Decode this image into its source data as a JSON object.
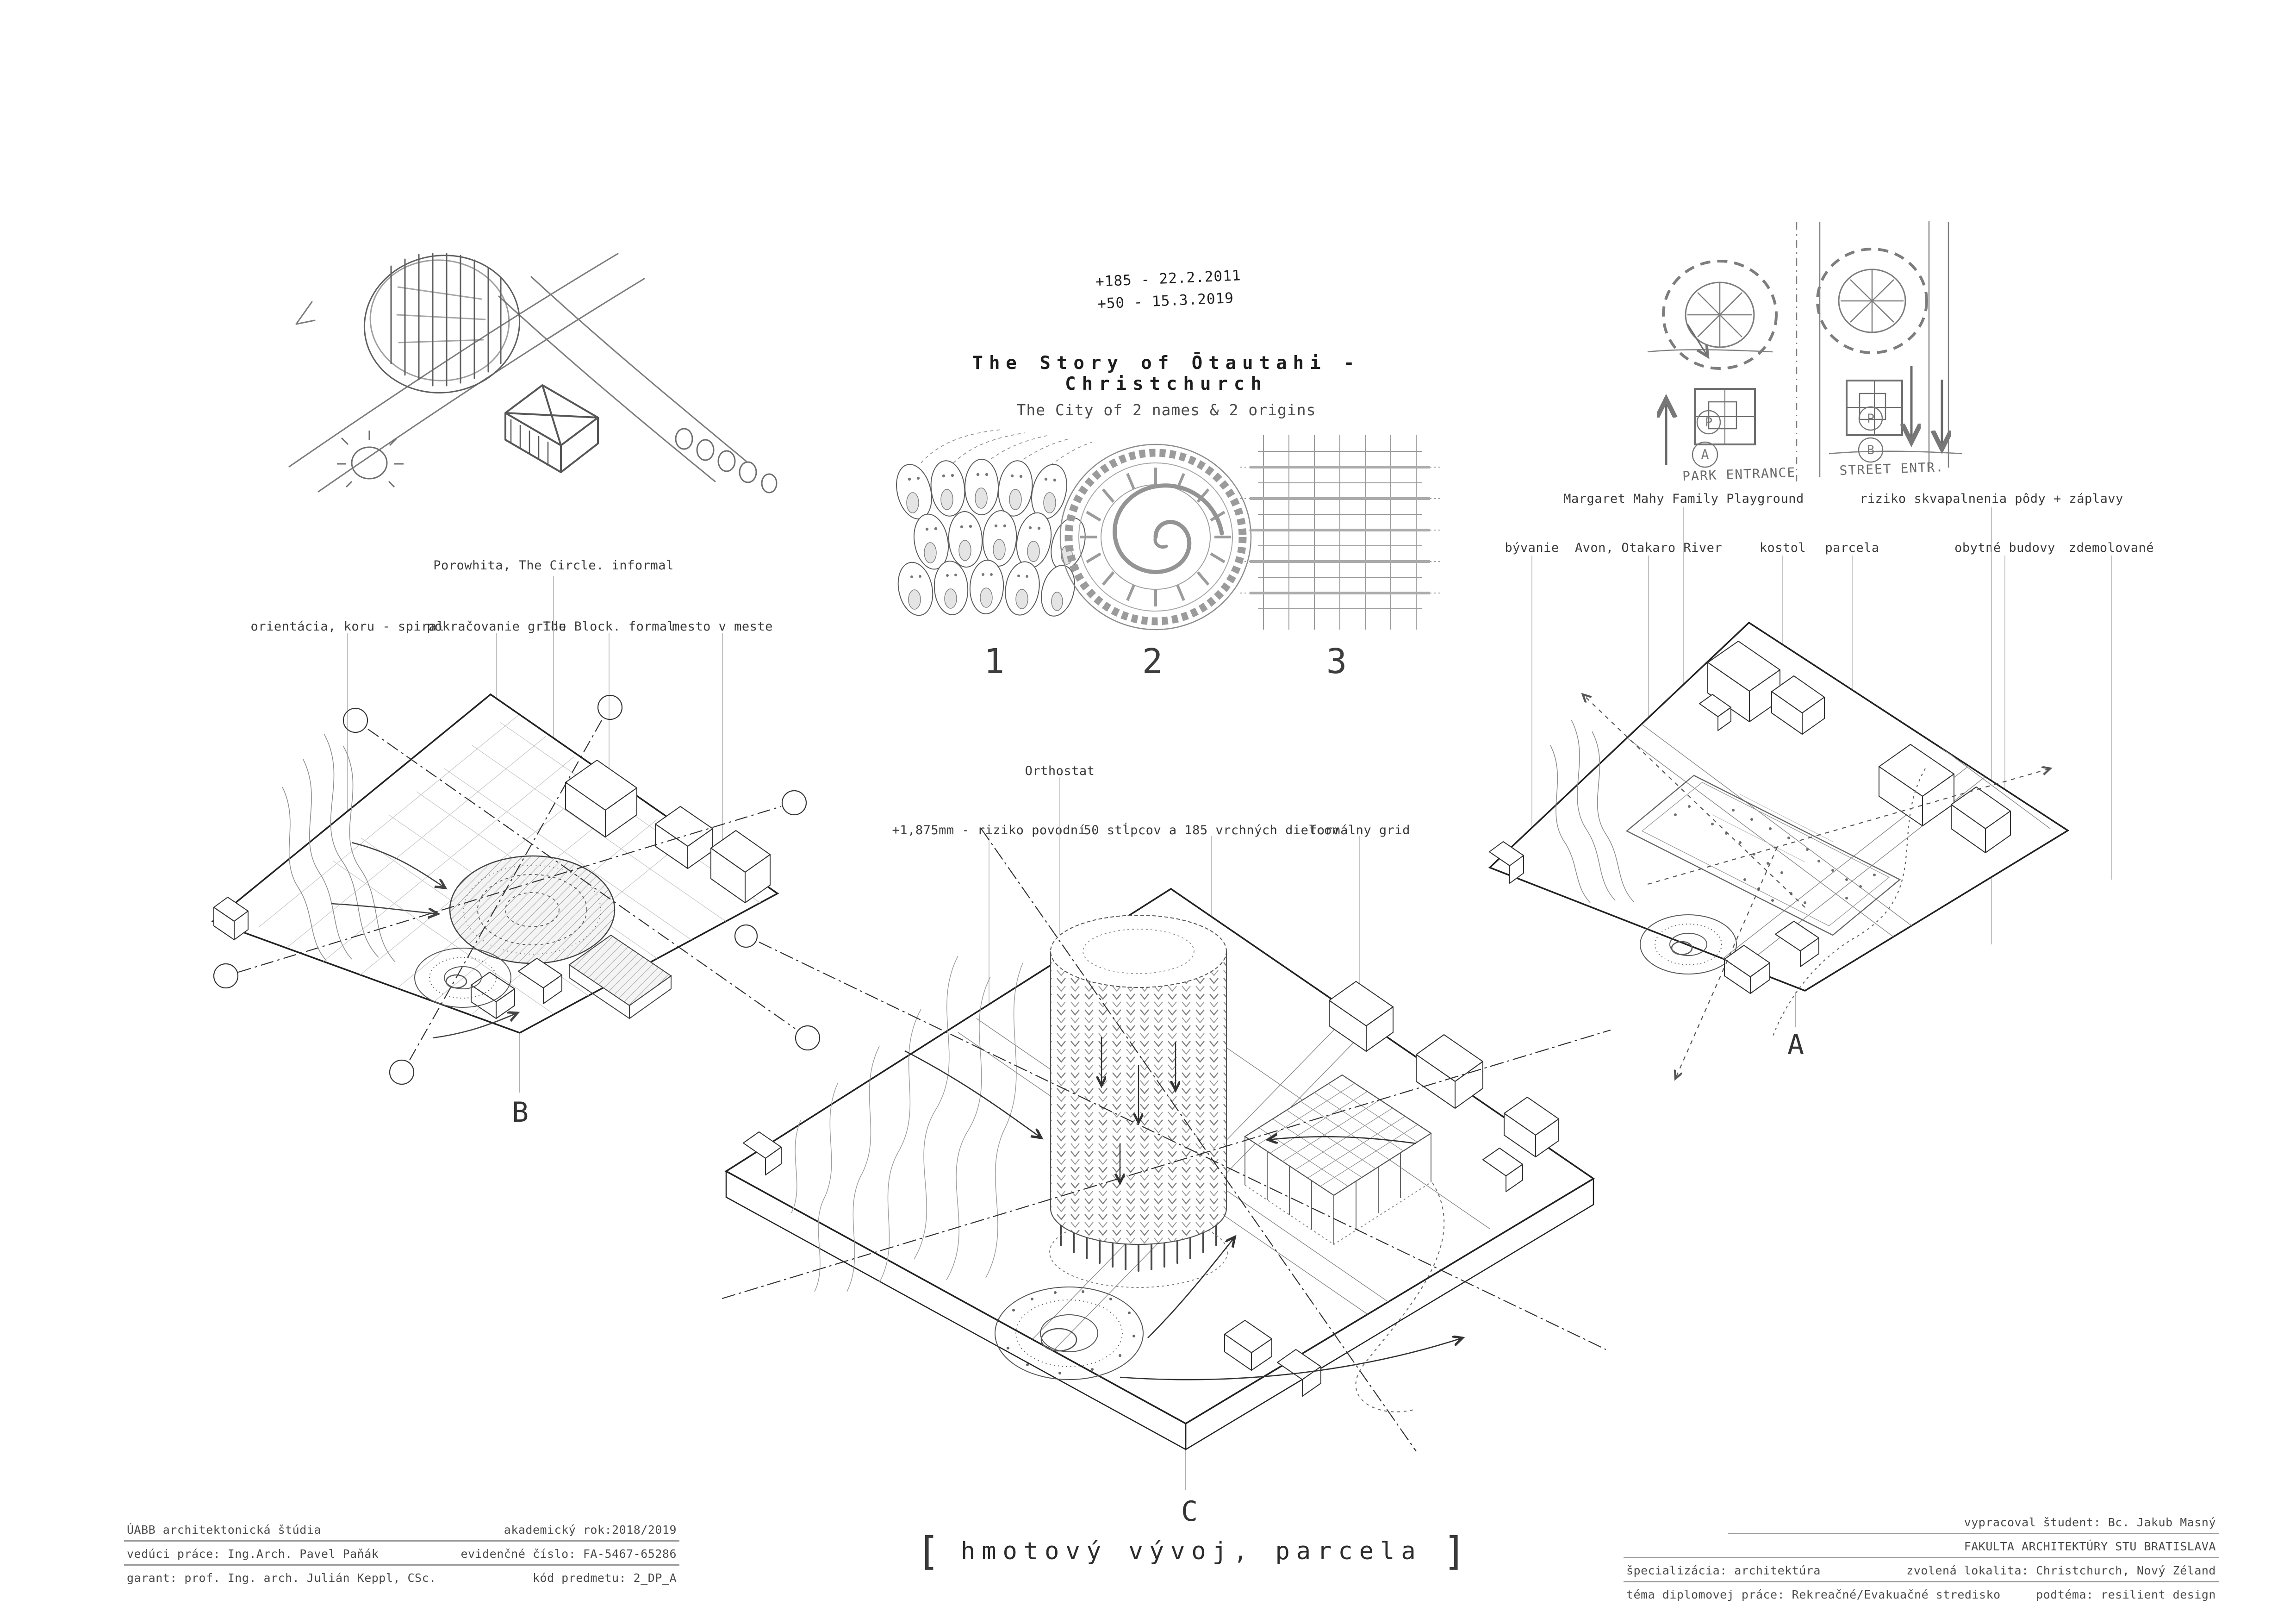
{
  "colors": {
    "ink": "#2e2e2e",
    "line": "#444444",
    "light_line": "#9a9a9a",
    "leader": "#b5b5b5",
    "paper": "#ffffff"
  },
  "header": {
    "dates": [
      "+185 - 22.2.2011",
      "+50 - 15.3.2019"
    ],
    "title": "The Story of Ōtautahi - Christchurch",
    "subtitle": "The City of 2 names & 2 origins"
  },
  "concepts": {
    "numbers": [
      "1",
      "2",
      "3"
    ],
    "descriptions": [
      "koru cluster - informal origin",
      "porowhita - carved circle with koru spiral",
      "formal orthogonal grid"
    ]
  },
  "sketch_tr": {
    "park_label": "PARK ENTRANCE",
    "street_label": "STREET ENTR.",
    "badge_p1": "P",
    "badge_a": "A",
    "badge_p2": "P",
    "badge_b": "B"
  },
  "axon_b": {
    "letter": "B",
    "label_top": "Porowhita, The Circle. informal",
    "labels": [
      "orientácia, koru - spiral",
      "pokračovanie gridu",
      "The Block. formal",
      "mesto v meste"
    ]
  },
  "axon_a": {
    "letter": "A",
    "labels_top": [
      "Margaret Mahy Family Playground",
      "riziko skvapalnenia pôdy + záplavy"
    ],
    "labels": [
      "bývanie",
      "Avon, Otakaro River",
      "kostol",
      "parcela",
      "obytné budovy",
      "zdemolované"
    ]
  },
  "axon_c": {
    "letter": "C",
    "label_top": "Orthostat",
    "labels": [
      "+1,875mm - riziko povodní",
      "50 stĺpcov a 185 vrchných dielcov",
      "formálny grid"
    ]
  },
  "caption": {
    "bracket_left": "[",
    "text": "hmotový vývoj, parcela",
    "bracket_right": "]"
  },
  "titleblock_left": {
    "rows": [
      {
        "left": "ÚABB   architektonická štúdia",
        "right": "akademický rok:2018/2019"
      },
      {
        "left": "vedúci práce:  Ing.Arch. Pavel Paňák",
        "right": "evidenčné číslo: FA-5467-65286"
      },
      {
        "left": "garant: prof. Ing. arch. Julián Keppl, CSc.",
        "right": "kód predmetu: 2_DP_A"
      }
    ]
  },
  "titleblock_right": {
    "row1": "vypracoval študent: Bc. Jakub Masný",
    "row2": "FAKULTA ARCHITEKTÚRY STU BRATISLAVA",
    "row3": {
      "left": "špecializácia:  architektúra",
      "right": "zvolená lokalita: Christchurch, Nový Zéland"
    },
    "row4": {
      "left": "téma diplomovej práce: Rekreačné/Evakuačné stredisko",
      "right": "podtéma: resilient design"
    }
  }
}
